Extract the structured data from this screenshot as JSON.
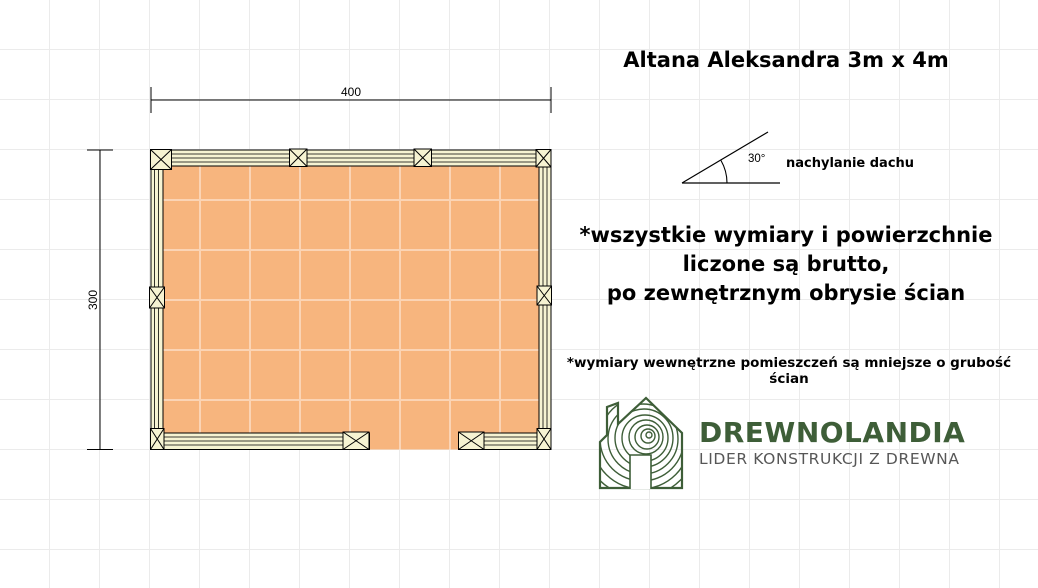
{
  "title": "Altana Aleksandra 3m x 4m",
  "plan": {
    "width_label": "400",
    "height_label": "300"
  },
  "roof": {
    "angle_label": "30°",
    "caption": "nachylanie dachu"
  },
  "notes": {
    "main": "*wszystkie wymiary i powierzchnie\nliczone są brutto,\npo zewnętrznym obrysie ścian",
    "secondary": "*wymiary wewnętrzne pomieszczeń są mniejsze o grubość ścian"
  },
  "brand": {
    "name": "DREWNOLANDIA",
    "tagline": "LIDER KONSTRUKCJI Z DREWNA",
    "logo_icon": "wood-grain-house-icon"
  },
  "colors": {
    "background": "#ffffff",
    "page_grid": "#ebebeb",
    "floor_fill": "#f7b57e",
    "floor_grid": "#fbd4b5",
    "wall_fill": "#f6f3d2",
    "line": "#000000",
    "brand_green": "#3e5e38",
    "tagline_gray": "#575757"
  }
}
